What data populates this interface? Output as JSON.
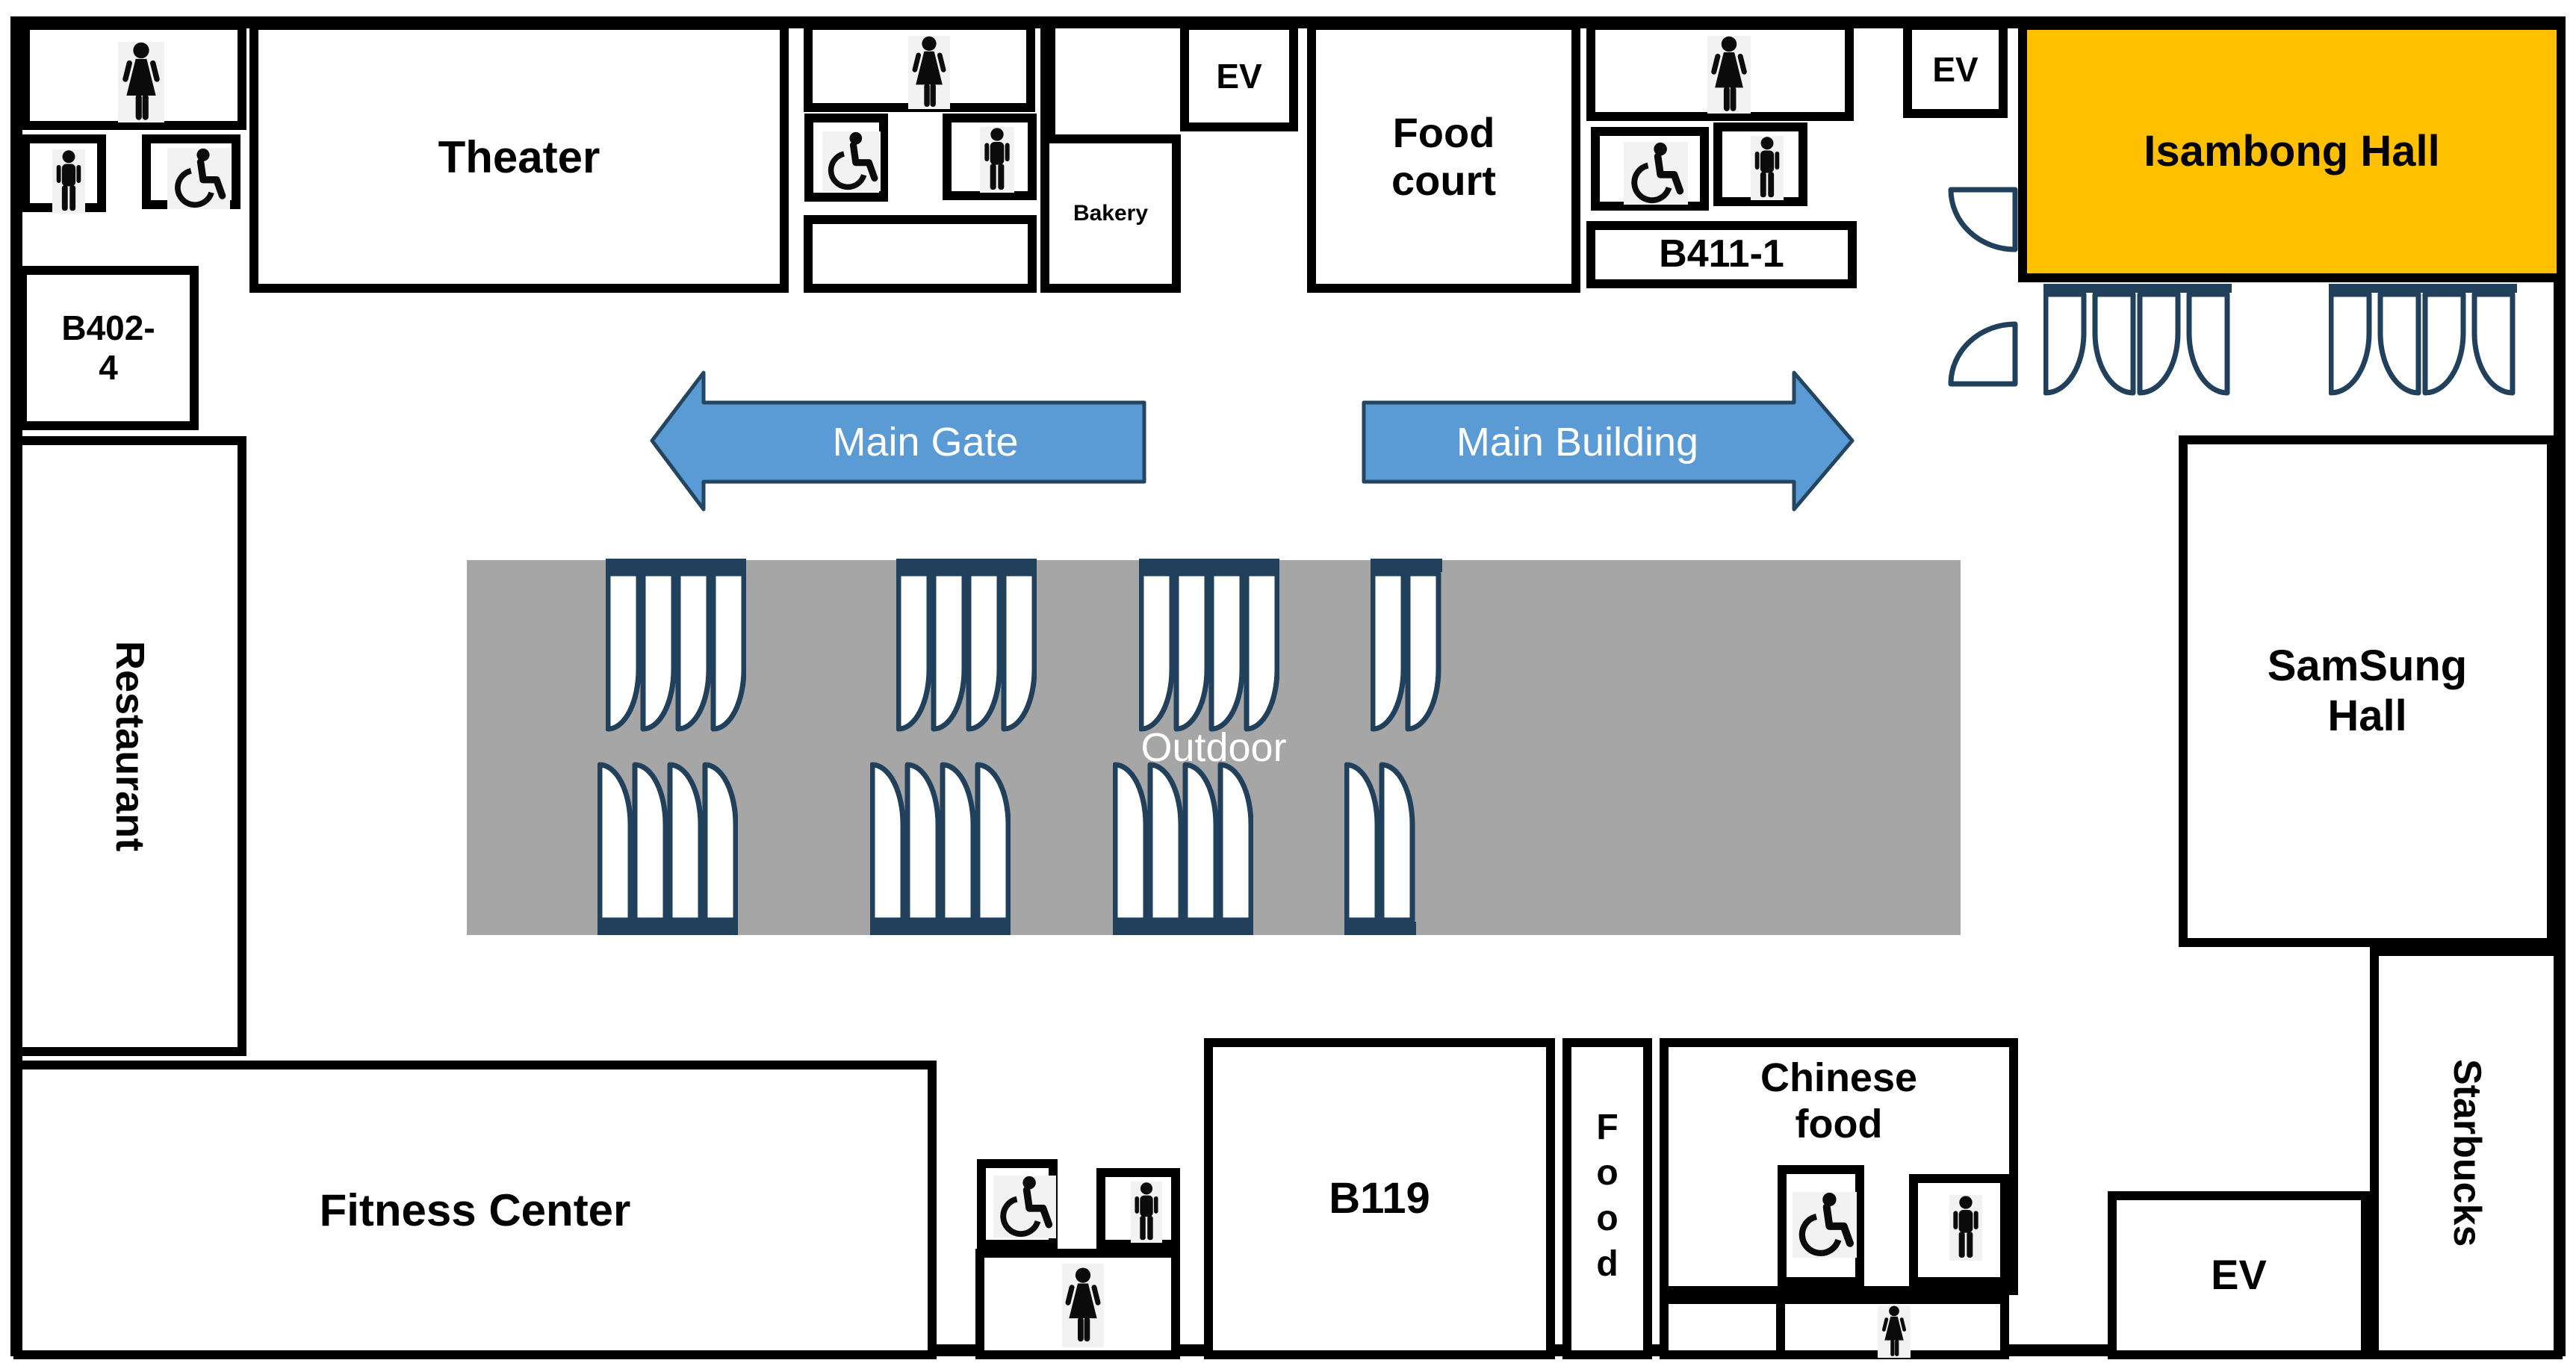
{
  "title": "Building floor plan",
  "colors": {
    "hall_fill": "#FFC000",
    "outdoor_fill": "#A6A6A6",
    "arrow_fill": "#5B9BD5",
    "arrow_border": "#24455F",
    "door_outline": "#21405C",
    "wall": "#000000",
    "label_text": "#000000",
    "arrow_text": "#FFFFFF"
  },
  "rooms": {
    "theater": {
      "label": "Theater"
    },
    "b402_4": {
      "label": "B402-\n4"
    },
    "restaurant": {
      "label": "Restaurant"
    },
    "bakery": {
      "label": "Bakery"
    },
    "ev_top": {
      "label": "EV"
    },
    "food_court": {
      "label": "Food\ncourt"
    },
    "b411_1": {
      "label": "B411-1"
    },
    "ev_top_right": {
      "label": "EV"
    },
    "isambong": {
      "label": "Isambong Hall"
    },
    "samsung": {
      "label": "SamSung\nHall"
    },
    "starbucks": {
      "label": "Starbucks"
    },
    "fitness": {
      "label": "Fitness Center"
    },
    "b119": {
      "label": "B119"
    },
    "food_corridor": {
      "label": "Food"
    },
    "chinese": {
      "label": "Chinese\nfood"
    },
    "ev_bottom": {
      "label": "EV"
    }
  },
  "signs": {
    "main_gate": "Main Gate",
    "main_building": "Main Building",
    "outdoor": "Outdoor"
  },
  "icons": {
    "woman": "woman-restroom-icon",
    "man": "man-restroom-icon",
    "accessible": "wheelchair-accessible-icon",
    "door": "door-swing-icon"
  }
}
